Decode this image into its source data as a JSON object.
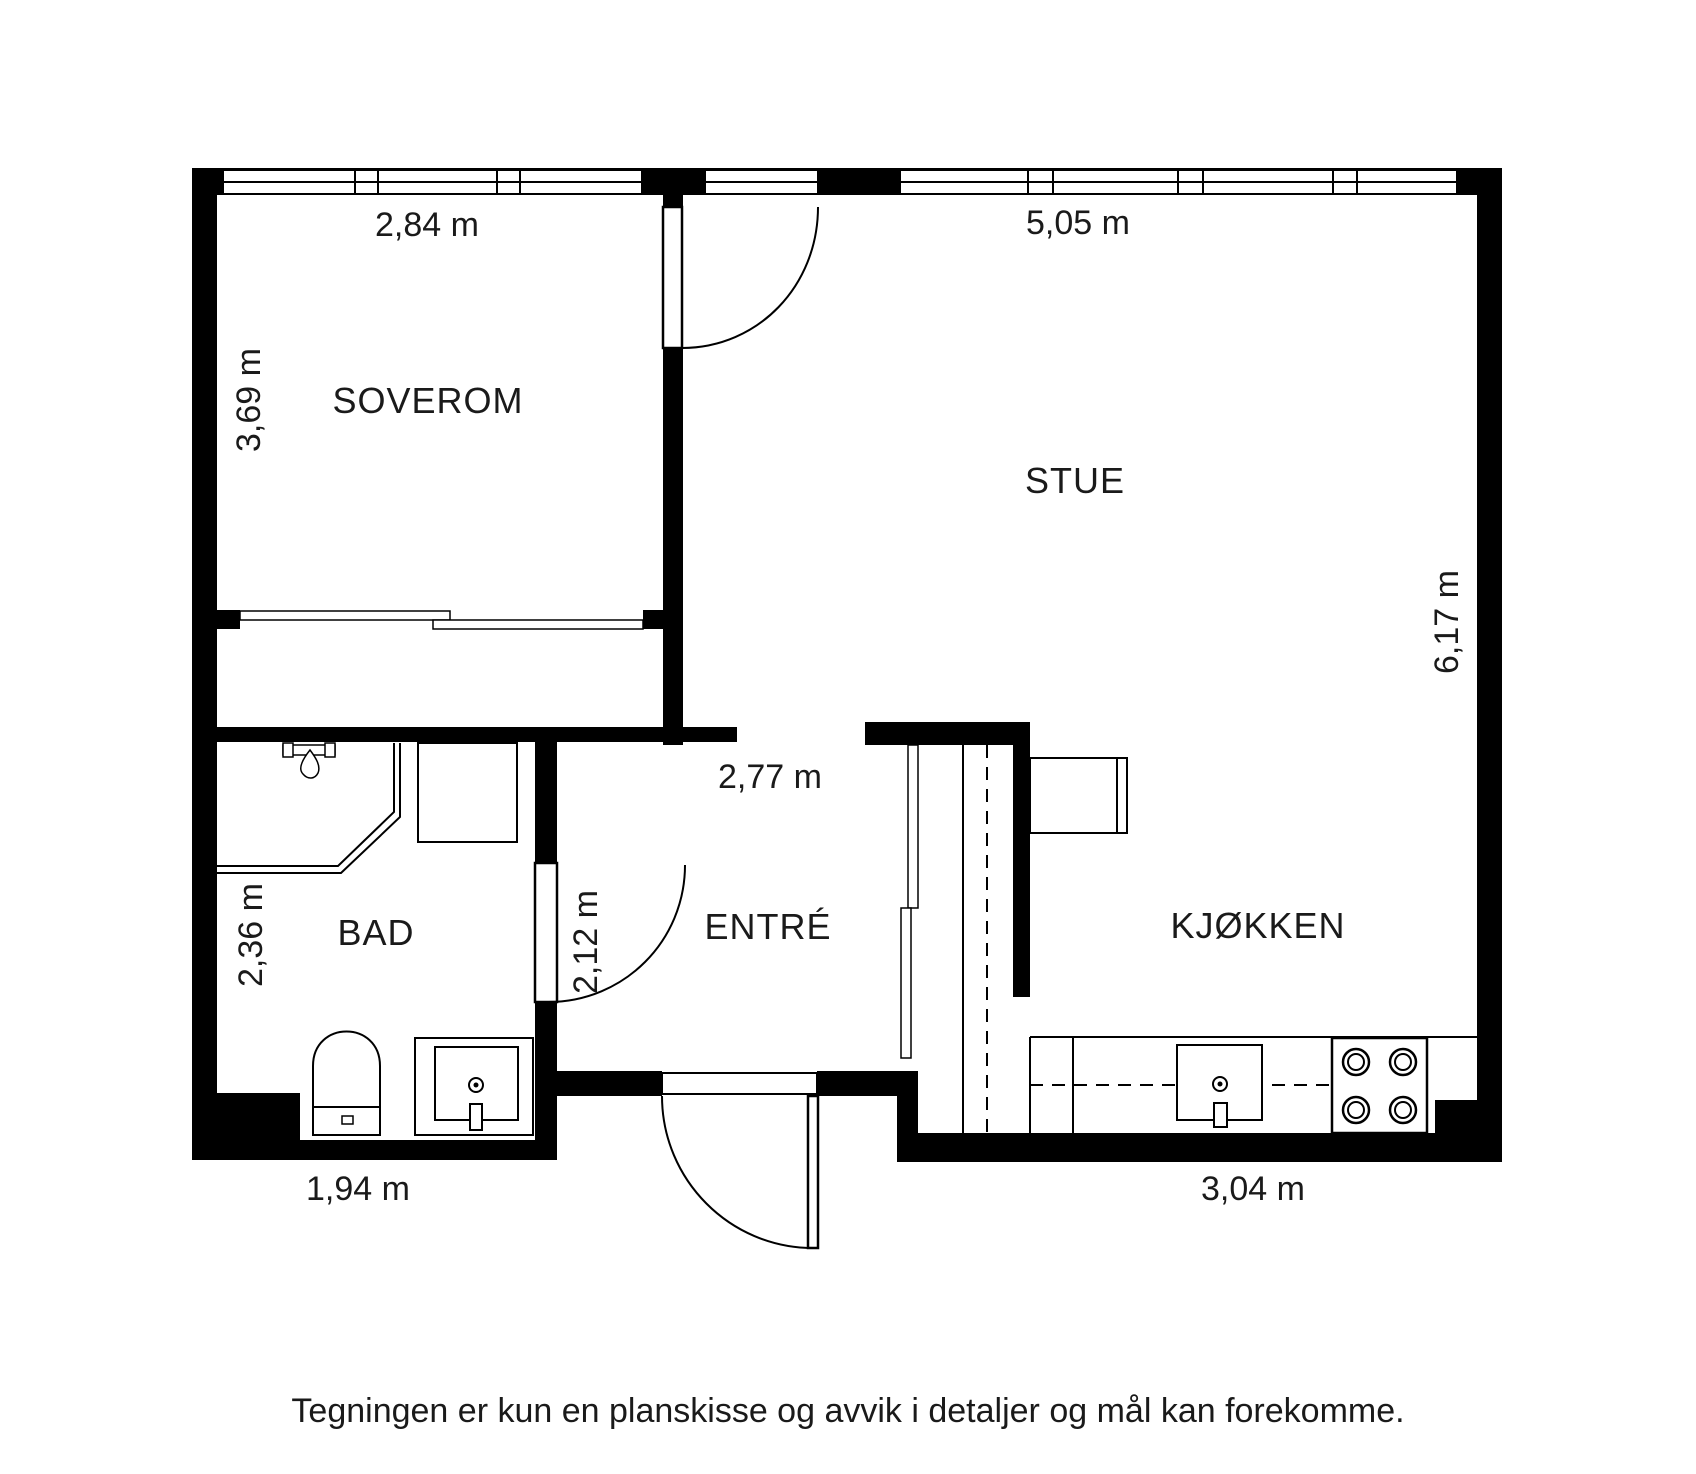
{
  "title": "Sørligata 8D",
  "disclaimer": "Tegningen er kun en planskisse og avvik i detaljer og mål kan forekomme.",
  "plan": {
    "rooms": [
      {
        "id": "soverom",
        "label": "SOVEROM",
        "width_label": "2,84 m",
        "height_label": "3,69 m"
      },
      {
        "id": "stue",
        "label": "STUE",
        "width_label": "5,05 m",
        "height_label": "6,17 m"
      },
      {
        "id": "bad",
        "label": "BAD",
        "width_label": "1,94 m",
        "height_label": "2,36 m"
      },
      {
        "id": "entre",
        "label": "ENTRÉ",
        "width_label": "2,77 m",
        "height_label": "2,12 m"
      },
      {
        "id": "kjokken",
        "label": "KJØKKEN",
        "width_label": "3,04 m",
        "height_label": ""
      }
    ],
    "fixtures": [
      "balcony-door",
      "bedroom-closet-sliding-doors",
      "shower-corner",
      "shower-head",
      "washing-machine",
      "toilet",
      "bathroom-sink",
      "bathroom-door",
      "entrance-door",
      "hall-wardrobe-sliding-doors",
      "tall-cabinet",
      "kitchen-peninsula-cabinet",
      "kitchen-counter",
      "kitchen-sink",
      "stove-4-burners"
    ],
    "colors": {
      "wall": "#000000",
      "background": "#ffffff",
      "text": "#1a1a1a"
    }
  }
}
